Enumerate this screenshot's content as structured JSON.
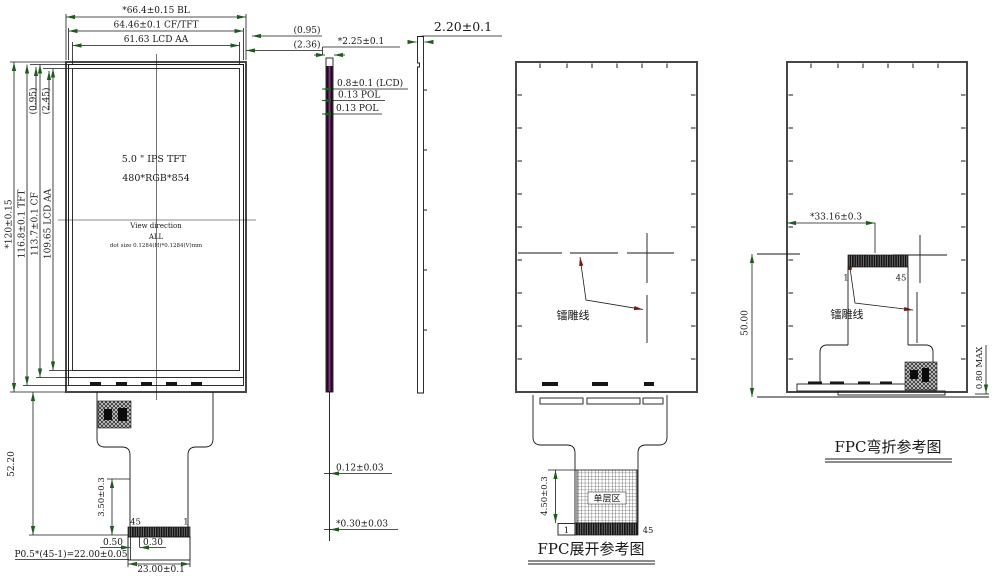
{
  "front_view": {
    "dim_width_bl": "*66.4±0.15 BL",
    "dim_width_cftft": "64.46±0.1 CF/TFT",
    "dim_width_aa": "61.63 LCD AA",
    "gap_right_cf": "(0.95)",
    "gap_right_aa": "(2.36)",
    "gap_left_cf": "(0.95)",
    "gap_left_aa": "(2.45)",
    "dim_height_bl": "*120±0.15",
    "dim_height_tft": "116.8±0.1 TFT",
    "dim_height_cf": "113.7±0.1 CF",
    "dim_height_aa": "109.65 LCD AA",
    "panel_size": "5.0 \" IPS TFT",
    "resolution": "480*RGB*854",
    "view_direction_label": "View direction",
    "view_direction_value": "ALL",
    "dot_size": "dot size 0.1284(H)*0.1284(V)mm",
    "dim_fpc_length": "52.20",
    "dim_stiffener": "3.50±0.3",
    "pin_left": "45",
    "pin_right": "1",
    "dim_margin": "0.50",
    "dim_pin_width": "0.30",
    "dim_pitch": "P0.5*(45-1)=22.00±0.05",
    "dim_connector_width": "23.00±0.1"
  },
  "side_view": {
    "dim_thickness_total": "*2.25±0.1",
    "dim_thickness_tp": "2.20±0.1",
    "dim_lcd": "0.8±0.1 (LCD)",
    "dim_pol_top": "0.13 POL",
    "dim_pol_bottom": "0.13 POL",
    "dim_fpc": "0.12±0.03",
    "dim_tape": "*0.30±0.03"
  },
  "fpc_open_view": {
    "laser_line_label": "镭雕线",
    "dim_single_layer": "4.50±0.3",
    "pin_left": "1",
    "pin_right": "45",
    "single_layer_area": "单层区",
    "caption": "FPC展开参考图"
  },
  "fpc_bend_view": {
    "dim_connector_offset": "*33.16±0.3",
    "pin_left": "1",
    "pin_right": "45",
    "laser_line_label": "镭雕线",
    "dim_height": "50.00",
    "dim_max_thickness": "0.80 MAX",
    "caption": "FPC弯折参考图"
  },
  "colors": {
    "line": "#181818",
    "arrow": "#1d5c1d",
    "leader_arrow": "#7a1a10",
    "polarizer": "#b515b5"
  }
}
